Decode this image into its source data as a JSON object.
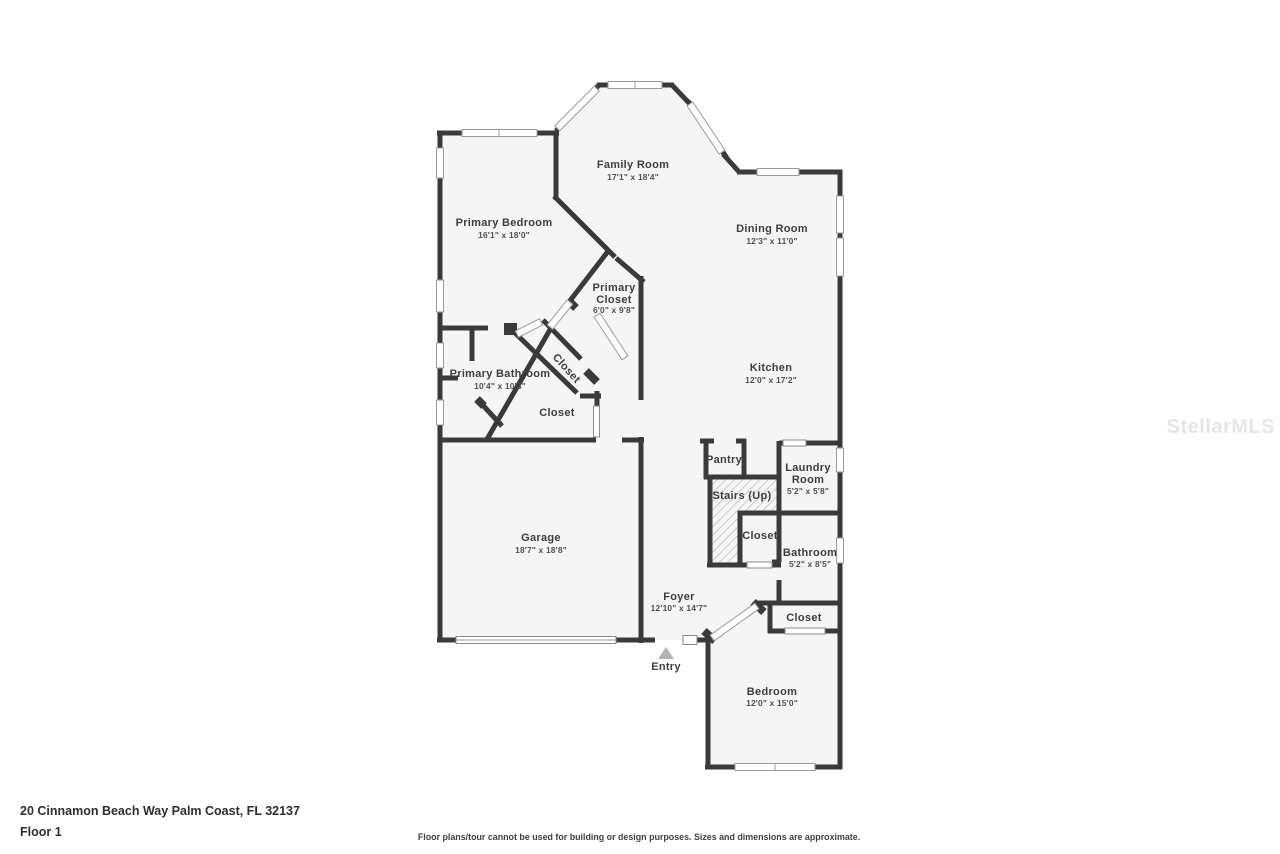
{
  "watermark": "StellarMLS",
  "footer": {
    "address": "20 Cinnamon Beach Way Palm Coast, FL 32137",
    "floor_label": "Floor 1",
    "disclaimer": "Floor plans/tour cannot be used for building or design purposes. Sizes and dimensions are approximate."
  },
  "rooms": {
    "family_room": {
      "name": "Family Room",
      "dims": "17'1\" x 18'4\""
    },
    "primary_bedroom": {
      "name": "Primary Bedroom",
      "dims": "16'1\" x 18'0\""
    },
    "dining_room": {
      "name": "Dining Room",
      "dims": "12'3\" x 11'0\""
    },
    "primary_closet": {
      "name_line1": "Primary",
      "name_line2": "Closet",
      "dims": "6'0\" x 9'8\""
    },
    "kitchen": {
      "name": "Kitchen",
      "dims": "12'0\" x 17'2\""
    },
    "primary_bathroom": {
      "name": "Primary Bathroom",
      "dims": "10'4\" x 10'3\""
    },
    "closet_angled": {
      "name": "Closet"
    },
    "closet_hall": {
      "name": "Closet"
    },
    "garage": {
      "name": "Garage",
      "dims": "18'7\" x 18'8\""
    },
    "pantry": {
      "name": "Pantry"
    },
    "stairs": {
      "name": "Stairs (Up)"
    },
    "laundry": {
      "name_line1": "Laundry",
      "name_line2": "Room",
      "dims": "5'2\" x 5'8\""
    },
    "closet_stairs": {
      "name": "Closet"
    },
    "bathroom": {
      "name": "Bathroom",
      "dims": "5'2\" x 8'5\""
    },
    "foyer": {
      "name": "Foyer",
      "dims": "12'10\" x 14'7\""
    },
    "entry": {
      "name": "Entry"
    },
    "closet_bedroom": {
      "name": "Closet"
    },
    "bedroom": {
      "name": "Bedroom",
      "dims": "12'0\" x 15'0\""
    }
  }
}
